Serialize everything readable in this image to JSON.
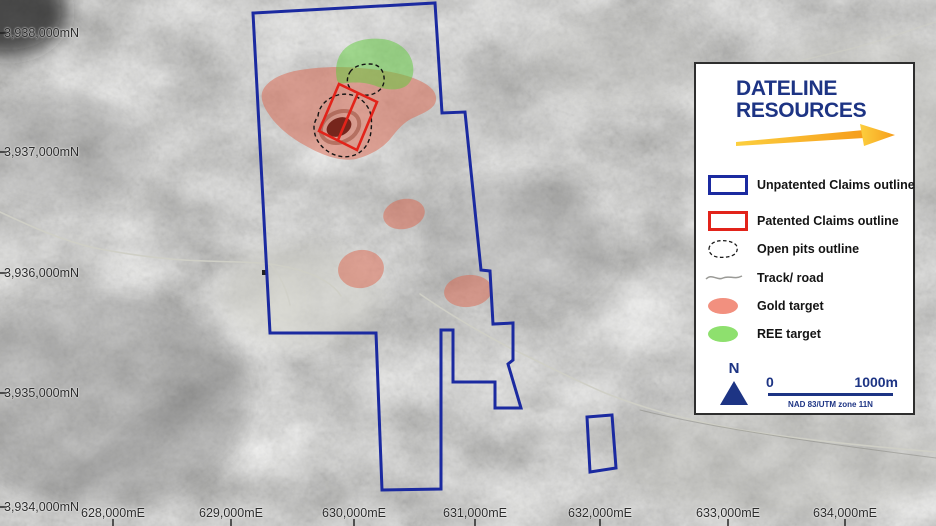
{
  "map": {
    "axis": {
      "northing_labels": [
        {
          "text": "3,938,000mN",
          "y": 33
        },
        {
          "text": "3,937,000mN",
          "y": 152
        },
        {
          "text": "3,936,000mN",
          "y": 273
        },
        {
          "text": "3,935,000mN",
          "y": 393
        },
        {
          "text": "3,934,000mN",
          "y": 507
        }
      ],
      "easting_labels": [
        {
          "text": "628,000mE",
          "x": 113
        },
        {
          "text": "629,000mE",
          "x": 231
        },
        {
          "text": "630,000mE",
          "x": 354
        },
        {
          "text": "631,000mE",
          "x": 475
        },
        {
          "text": "632,000mE",
          "x": 600
        },
        {
          "text": "633,000mE",
          "x": 728
        },
        {
          "text": "634,000mE",
          "x": 845
        }
      ]
    },
    "features": {
      "unpatented_claims": "Unpatented Claims outline polygon with southern neck and detached small claim block near 632,000mE",
      "patented_claims": "Rotated two-lot patented claim rectangle over main open pit",
      "open_pits": "Two dashed open pit outlines, dark pit floor in larger pit",
      "gold_targets_count": 4,
      "ree_targets_count": 1
    }
  },
  "legend": {
    "logo": {
      "line1": "DATELINE",
      "line2": "RESOURCES"
    },
    "items": [
      {
        "label": "Unpatented Claims outline",
        "swatch": "blue-rect"
      },
      {
        "label": "Patented Claims outline",
        "swatch": "red-rect"
      },
      {
        "label": "Open pits outline",
        "swatch": "dashed-blob"
      },
      {
        "label": "Track/ road",
        "swatch": "gray-line"
      },
      {
        "label": "Gold target",
        "swatch": "gold-ellipse"
      },
      {
        "label": "REE target",
        "swatch": "green-ellipse"
      }
    ],
    "north_label": "N",
    "scale": {
      "start": "0",
      "end": "1000m",
      "datum": "NAD 83/UTM zone 11N"
    }
  },
  "colors": {
    "unpatented_claims_outline": "#1b2aa0",
    "patented_claims_outline": "#e2231a",
    "open_pits_outline": "#141414",
    "track_road": "#cfcfc6",
    "gold_target": "#dd6a52",
    "ree_target": "#5ecb3a",
    "gold_swatch": "#f2907f",
    "ree_swatch": "#8ee06e",
    "brand_navy": "#1d3484",
    "arrow_yellow": "#fccf3e",
    "arrow_orange": "#f69d1c",
    "pit_floor": "#69160c"
  }
}
